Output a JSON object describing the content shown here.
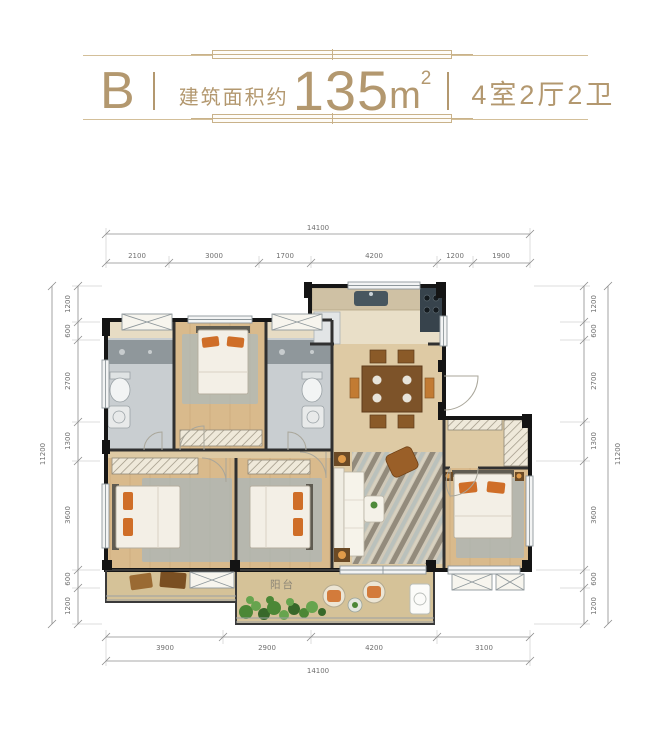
{
  "header": {
    "type_label": "B",
    "area_prefix": "建筑面积约",
    "area_value": "135",
    "area_unit": "m",
    "area_exponent": "2",
    "rooms_label": "4室2厅2卫",
    "accent_color": "#b3986f"
  },
  "plan": {
    "balcony_label": "阳台",
    "dims": {
      "top_total": "14100",
      "top_segments": [
        "2100",
        "3000",
        "1700",
        "4200",
        "1200",
        "1900"
      ],
      "bottom_segments": [
        "3900",
        "2900",
        "4200",
        "3100"
      ],
      "bottom_total": "14100",
      "left_segments": [
        "1200",
        "600",
        "2700",
        "1300",
        "3600",
        "600",
        "1200"
      ],
      "left_total": "11200",
      "right_segments": [
        "1200",
        "600",
        "2700",
        "1300",
        "3600",
        "600",
        "1200"
      ],
      "right_total": "11200"
    }
  }
}
